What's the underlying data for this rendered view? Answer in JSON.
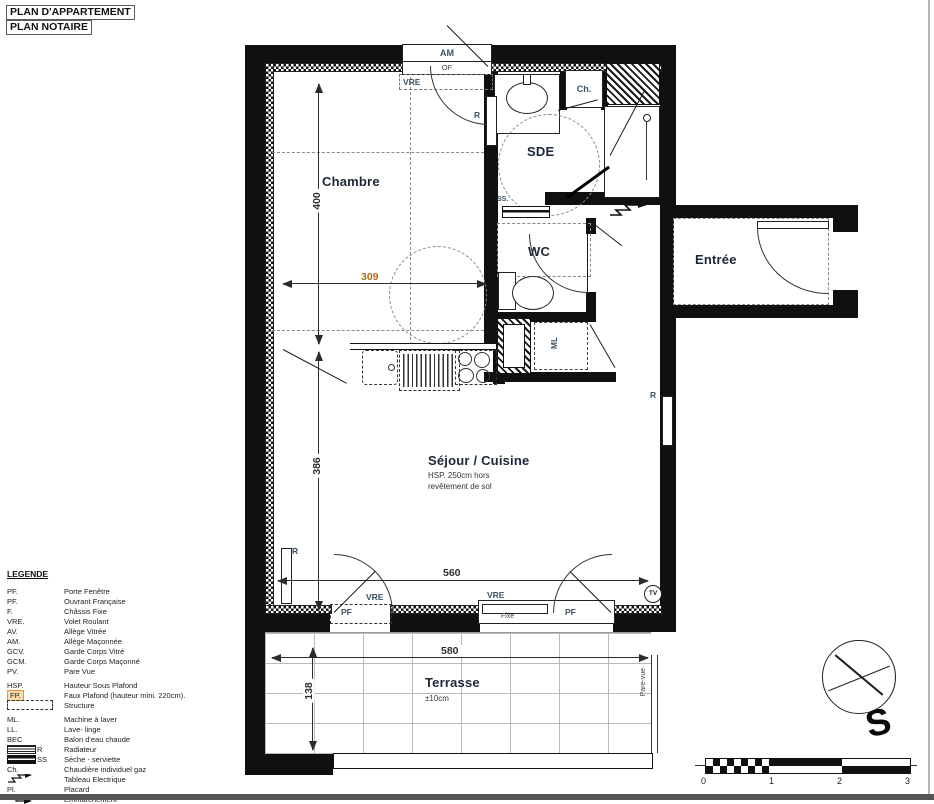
{
  "header": {
    "title1": "PLAN D'APPARTEMENT",
    "title2": "PLAN NOTAIRE"
  },
  "rooms": {
    "chambre": "Chambre",
    "sde": "SDE",
    "wc": "WC",
    "entree": "Entrée",
    "sejour": "Séjour / Cuisine",
    "sejour_note1": "HSP. 250cm hors",
    "sejour_note2": "revêtement de sol",
    "terrasse": "Terrasse",
    "terrasse_note": "±10cm"
  },
  "dims": {
    "chambre_h": "400",
    "chambre_w": "309",
    "sejour_h": "386",
    "sejour_w": "560",
    "terrasse_w": "580",
    "terrasse_d": "138"
  },
  "labels": {
    "am": "AM",
    "of": "OF",
    "vre": "VRE",
    "ch": "Ch.",
    "r": "R",
    "ss": "SS.",
    "ml": "ML",
    "pf": "PF",
    "fixe": "Fixe",
    "tv": "TV",
    "pare_vue": "Pare-vue",
    "south": "S"
  },
  "legend": {
    "title": "LEGENDE",
    "items": [
      {
        "abbr": "PF.",
        "label": "Porte Fenêtre"
      },
      {
        "abbr": "PF.",
        "label": "Ouvrant Française"
      },
      {
        "abbr": "F.",
        "label": "Châssis Fixe"
      },
      {
        "abbr": "VRE.",
        "label": "Volet Roulant"
      },
      {
        "abbr": "AV.",
        "label": "Allège Vitrée"
      },
      {
        "abbr": "AM.",
        "label": "Allège Maçonnée"
      },
      {
        "abbr": "GCV.",
        "label": "Garde Corps Vitré"
      },
      {
        "abbr": "GCM.",
        "label": "Garde Corps Maçonné"
      },
      {
        "abbr": "PV.",
        "label": "Pare Vue"
      },
      {
        "abbr": "HSP.",
        "label": "Hauteur Sous Plafond"
      },
      {
        "abbr": "FP.",
        "label": "Faux Plafond (hauteur mini. 220cm)."
      },
      {
        "abbr": "",
        "label": "Structure"
      },
      {
        "abbr": "ML.",
        "label": "Machine à laver"
      },
      {
        "abbr": "LL.",
        "label": "Lave- linge"
      },
      {
        "abbr": "BEC",
        "label": "Balon d'eau chaude"
      },
      {
        "abbr": "R",
        "label": "Radiateur"
      },
      {
        "abbr": "SS",
        "label": "Sèche - serviette"
      },
      {
        "abbr": "Ch.",
        "label": "Chaudière individuel gaz"
      },
      {
        "abbr": "",
        "label": "Tableau Electrique"
      },
      {
        "abbr": "Pl.",
        "label": "Placard"
      },
      {
        "abbr": "",
        "label": "Emmarchement"
      }
    ]
  },
  "scale_bar": {
    "ticks": [
      "0",
      "1",
      "2",
      "3"
    ]
  }
}
